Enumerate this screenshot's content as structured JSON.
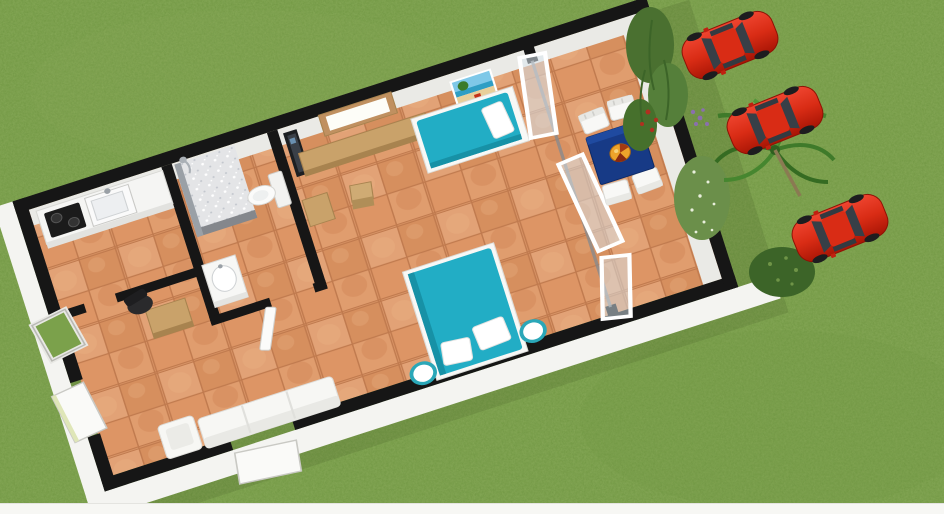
{
  "scene": {
    "description": "3D isometric rendering of a small one-bedroom house floor plan on a green lawn",
    "rooms": [
      "kitchen",
      "bathroom",
      "main-living-bedroom",
      "terrace"
    ],
    "objects": [
      "kitchen counter with sink and black cooktop",
      "walk-in shower with shower head",
      "toilet",
      "washbasin",
      "wall-mounted TV",
      "wood-framed window with sideboard",
      "beach poster",
      "wooden chair",
      "wooden side cabinet",
      "single bed with teal mattress and white pillow",
      "double bed with teal mattress and two white pillows",
      "two round nightstands",
      "white sofa and armchair",
      "desk with black office chair",
      "open glass sliding door panels",
      "terrace table with dark blue cloth and round emblem",
      "white terrace chairs",
      "open exterior doors and tilted window",
      "three red hatchback cars parked on the grass",
      "palm tree and garden bushes with purple and red flowers"
    ],
    "car_count": 3,
    "bed_count": 2,
    "terrace_chair_count": 4
  },
  "colors": {
    "grass": "#7ba14b",
    "grass_light": "#8cab5e",
    "tile": "#db9766",
    "grout": "#c07a4e",
    "wall_black": "#161616",
    "wall_white": "#f4f4f1",
    "wall_face": "#eaeae6",
    "teal": "#22adc5",
    "teal_dark": "#1791a6",
    "wood": "#c9a26a",
    "wood_dark": "#a8834f",
    "table_blue": "#173a86",
    "emblem": "#eda32b",
    "car_red": "#d92c15",
    "car_window": "#373f47",
    "palm": "#3f7a2a",
    "bush": "#557f3a",
    "bush_dark": "#3c6428",
    "white": "#ffffff",
    "strip": "#f7f7f4",
    "shower": "#e4e5e7"
  }
}
